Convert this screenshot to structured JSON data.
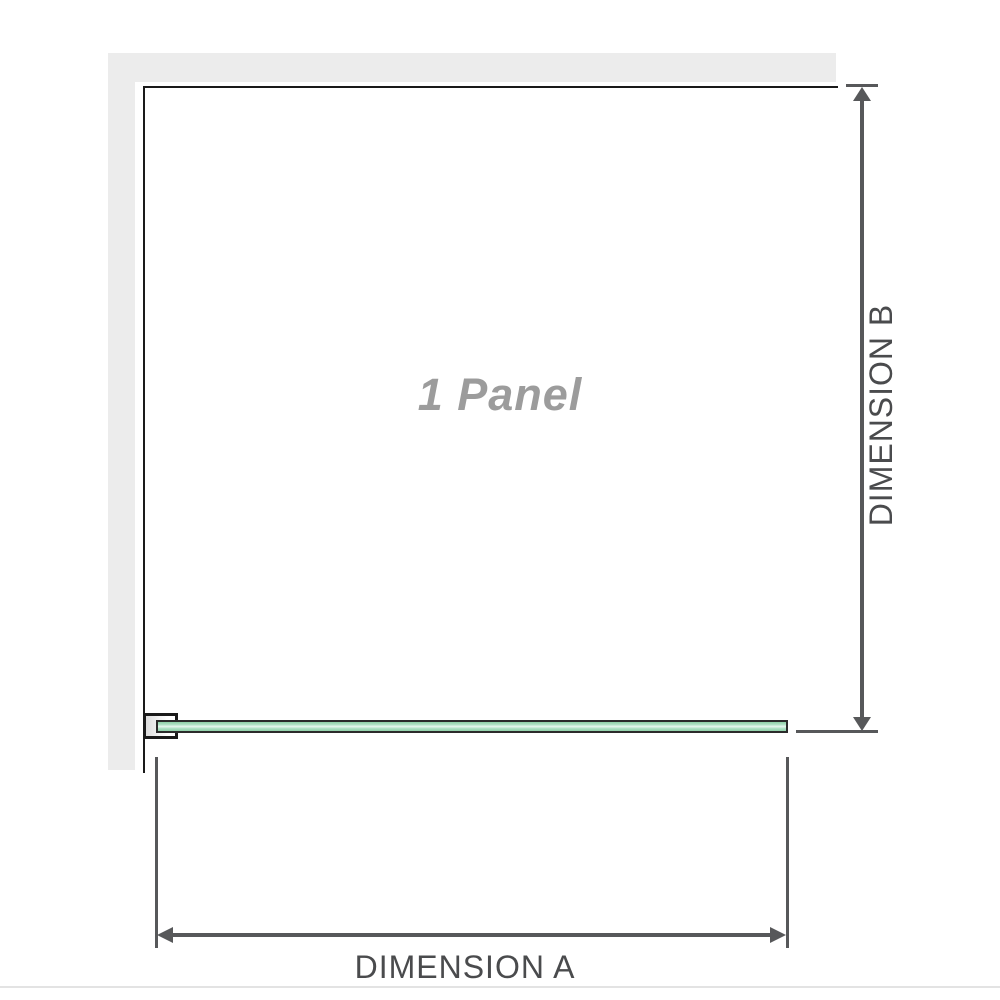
{
  "diagram": {
    "panel_label": "1 Panel",
    "dimension_a": {
      "label": "DIMENSION A"
    },
    "dimension_b": {
      "label": "DIMENSION B"
    }
  },
  "colors": {
    "wall_gray": "#ececec",
    "outline_black": "#1a1a1a",
    "glass_green": "#aee2c4",
    "glass_green_edge": "#8fd0a8",
    "glass_border": "#2b2b2b",
    "dimension_line_gray": "#57585a",
    "dimension_text_gray": "#4a4b4d",
    "panel_label_gray": "#9c9c9c",
    "divider_gray": "#e3e3e3"
  }
}
